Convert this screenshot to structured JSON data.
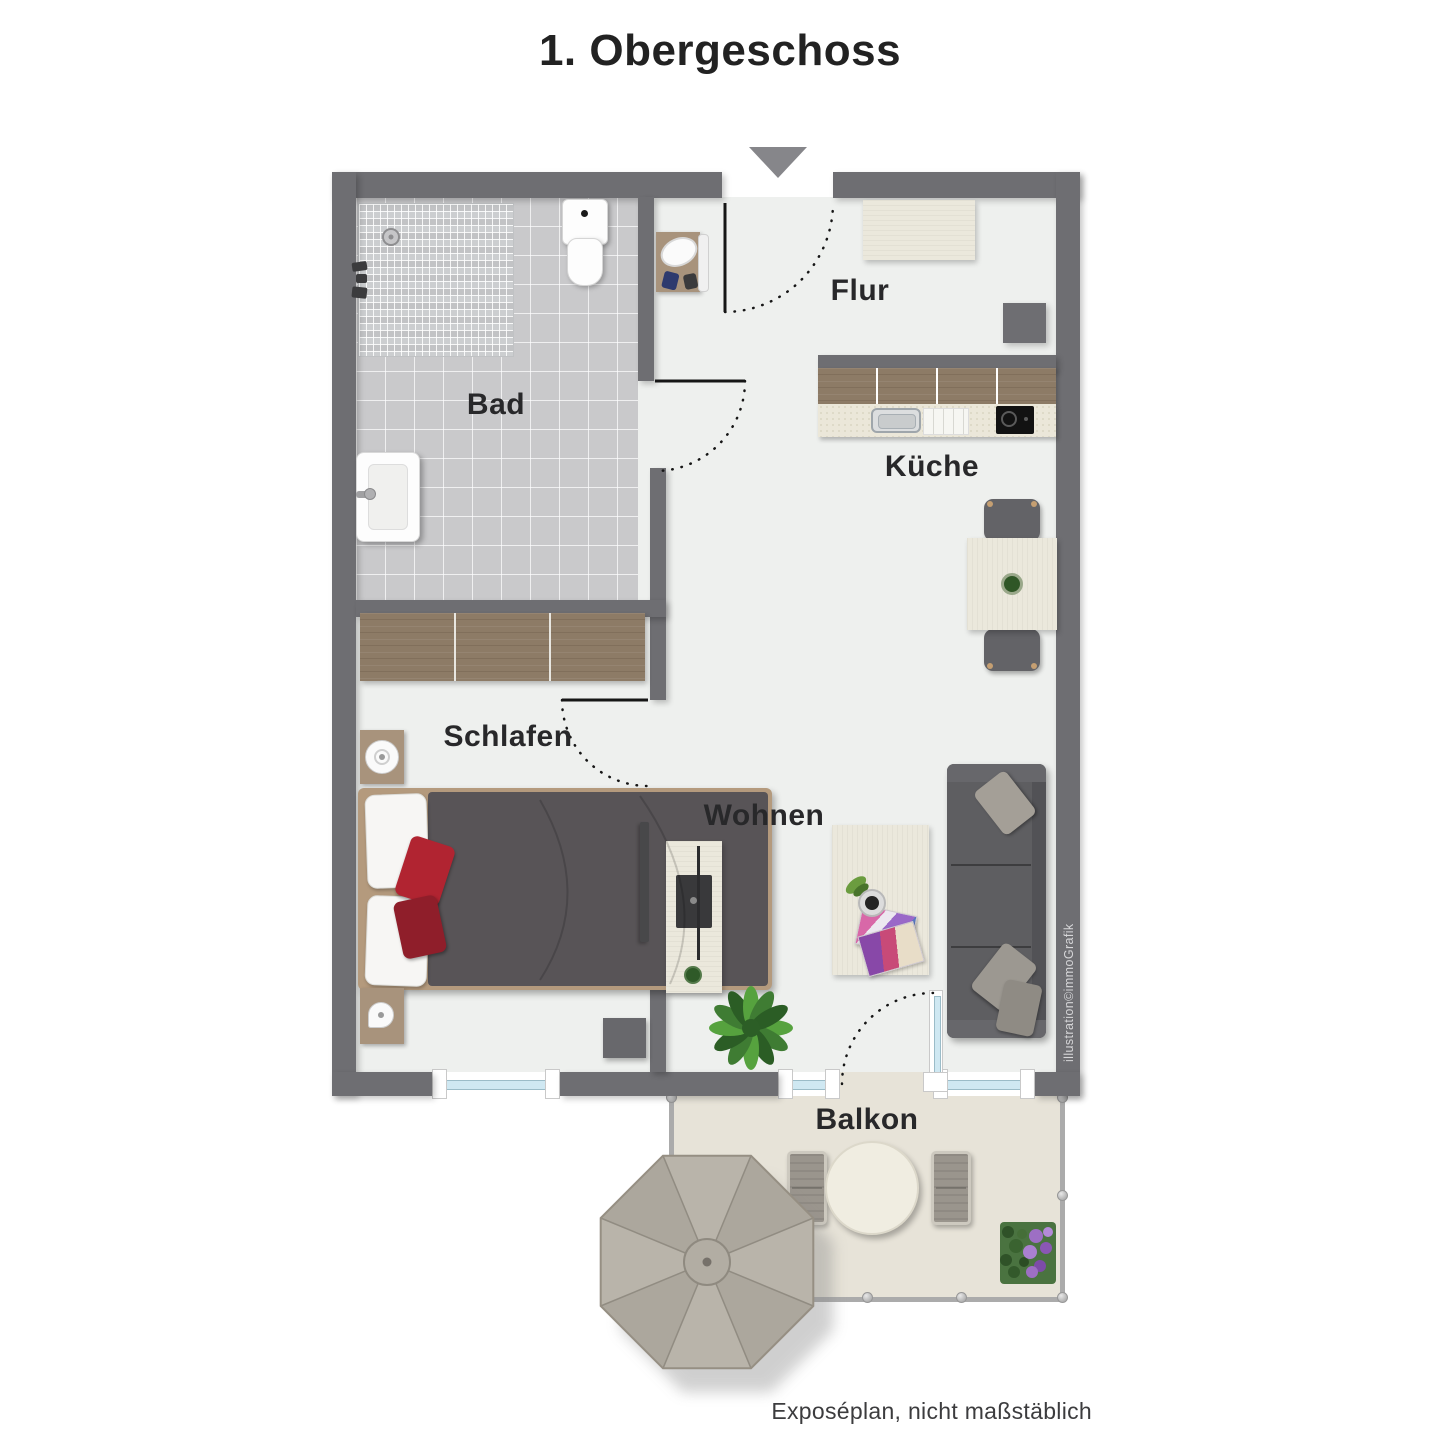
{
  "title": "1. Obergeschoss",
  "rooms": {
    "bad": "Bad",
    "flur": "Flur",
    "kueche": "Küche",
    "schlafen": "Schlafen",
    "wohnen": "Wohnen",
    "balkon": "Balkon"
  },
  "credits": {
    "illustrator": "illustration©immoGrafik",
    "disclaimer": "Exposéplan, nicht maßstäblich"
  },
  "icons": {
    "entry_arrow": "triangle-down"
  },
  "colors": {
    "wall": "#6e6e72",
    "floor": "#eef0ee",
    "bad_tile": "#c9c9cb",
    "balcony_floor": "#e7e3d8",
    "wood_dark": "#8d7b66",
    "wood_cream": "#ebe8dc",
    "duvet": "#585457",
    "accent_pillow": "#b12431",
    "sofa": "#5e5e61",
    "umbrella": "#b4afa5",
    "window_glass": "#cfe8f2",
    "label": "#28282a"
  }
}
